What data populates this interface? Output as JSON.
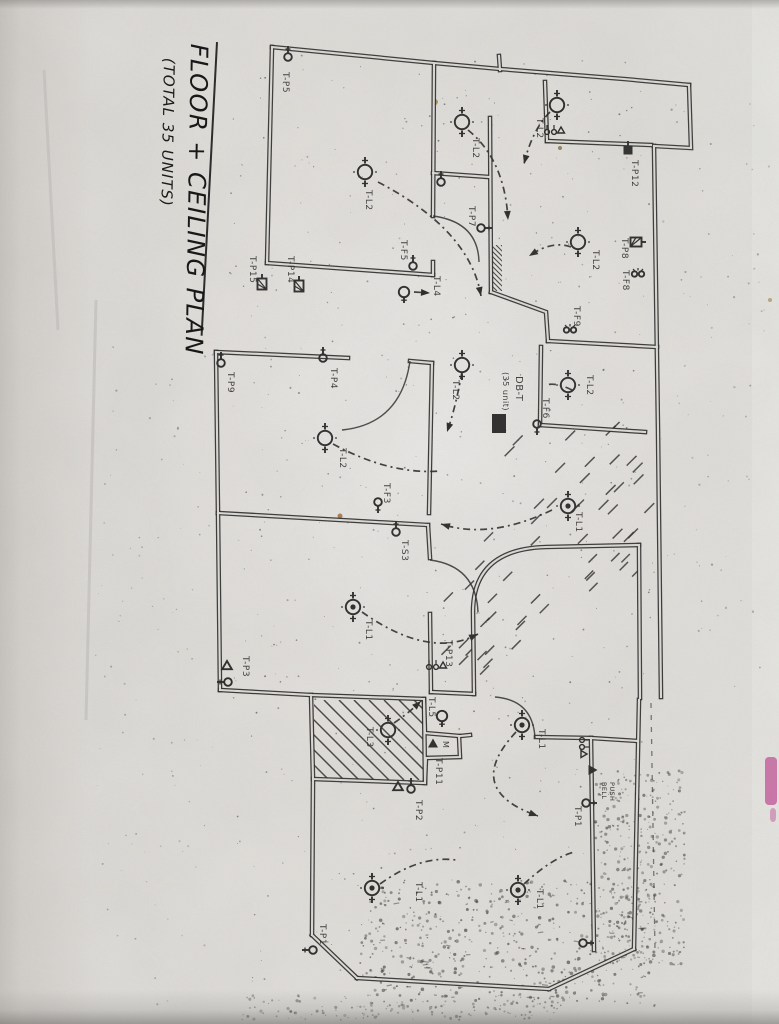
{
  "title": {
    "main": "FLOOR + CEILING PLAN",
    "sub": "(TOTAL 35 UNITS)"
  },
  "distribution_board": {
    "name": "DB-T",
    "capacity": "(35 unit)"
  },
  "annotations": {
    "bell_push": "BELL PUSH",
    "motor": "M"
  },
  "colors": {
    "ink": "#1b1b1b",
    "paper": "#e9e7e3",
    "smudge_pink": "#cc4f9d",
    "crease": "#c7c5c1"
  },
  "fixtures": [
    {
      "t": "light",
      "x": 365,
      "y": 172,
      "label": "T-L2",
      "lx": 366,
      "ly": 190
    },
    {
      "t": "light",
      "x": 462,
      "y": 122,
      "label": "T-L2",
      "lx": 473,
      "ly": 138
    },
    {
      "t": "light",
      "x": 557,
      "y": 105,
      "label": "T-L2",
      "lx": 537,
      "ly": 118
    },
    {
      "t": "light",
      "x": 578,
      "y": 242,
      "label": "T-L2",
      "lx": 593,
      "ly": 250
    },
    {
      "t": "light",
      "x": 568,
      "y": 385,
      "label": "T-L2",
      "lx": 587,
      "ly": 375
    },
    {
      "t": "light",
      "x": 462,
      "y": 365,
      "label": "T-L2",
      "lx": 453,
      "ly": 380
    },
    {
      "t": "light",
      "x": 325,
      "y": 438,
      "label": "T-L2",
      "lx": 340,
      "ly": 448
    },
    {
      "t": "lamp",
      "x": 404,
      "y": 292,
      "label": "T-L4",
      "lx": 434,
      "ly": 276
    },
    {
      "t": "light2",
      "x": 353,
      "y": 607,
      "label": "T-L1",
      "lx": 366,
      "ly": 620
    },
    {
      "t": "light2",
      "x": 568,
      "y": 506,
      "label": "T-L1",
      "lx": 576,
      "ly": 512
    },
    {
      "t": "light",
      "x": 388,
      "y": 730,
      "label": "T-L3",
      "lx": 367,
      "ly": 727
    },
    {
      "t": "lamp",
      "x": 442,
      "y": 716,
      "label": "T-L5",
      "lx": 429,
      "ly": 697
    },
    {
      "t": "light2",
      "x": 522,
      "y": 725,
      "label": "T-L1",
      "lx": 539,
      "ly": 729
    },
    {
      "t": "light2",
      "x": 372,
      "y": 888,
      "label": "T-L1",
      "lx": 416,
      "ly": 882
    },
    {
      "t": "light2",
      "x": 518,
      "y": 890,
      "label": "T-L1",
      "lx": 537,
      "ly": 889
    },
    {
      "t": "rose",
      "x": 288,
      "y": 57,
      "rot": 0,
      "label": "T-P5",
      "lx": 283,
      "ly": 72
    },
    {
      "t": "rose",
      "x": 413,
      "y": 266,
      "rot": 0,
      "label": "T-F5",
      "lx": 401,
      "ly": 240
    },
    {
      "t": "rose",
      "x": 441,
      "y": 182,
      "rot": 0,
      "label": ""
    },
    {
      "t": "rose",
      "x": 481,
      "y": 228,
      "rot": 90,
      "label": "T-P7",
      "lx": 469,
      "ly": 206
    },
    {
      "t": "sqf",
      "x": 628,
      "y": 150,
      "rot": 0,
      "label": "T-P12",
      "lx": 632,
      "ly": 160
    },
    {
      "t": "sqh",
      "x": 636,
      "y": 242,
      "rot": 90,
      "label": "T-P8",
      "lx": 622,
      "ly": 238
    },
    {
      "t": "fan",
      "x": 638,
      "y": 274,
      "rot": 0,
      "label": "T-F8",
      "lx": 623,
      "ly": 270
    },
    {
      "t": "fan",
      "x": 570,
      "y": 330,
      "rot": 0,
      "label": "T-F9",
      "lx": 574,
      "ly": 306
    },
    {
      "t": "sqh",
      "x": 262,
      "y": 284,
      "rot": 0,
      "label": "T-P15",
      "lx": 250,
      "ly": 256
    },
    {
      "t": "sqh",
      "x": 299,
      "y": 286,
      "rot": 0,
      "label": "T-P14",
      "lx": 288,
      "ly": 256
    },
    {
      "t": "rose",
      "x": 323,
      "y": 358,
      "rot": 0,
      "label": "T-P4",
      "lx": 331,
      "ly": 368
    },
    {
      "t": "rose",
      "x": 221,
      "y": 363,
      "rot": 0,
      "label": "T-P9",
      "lx": 228,
      "ly": 372
    },
    {
      "t": "rose",
      "x": 378,
      "y": 502,
      "rot": 180,
      "label": "T-F3",
      "lx": 384,
      "ly": 483
    },
    {
      "t": "rose",
      "x": 396,
      "y": 532,
      "rot": 0,
      "label": "T-S3",
      "lx": 402,
      "ly": 540
    },
    {
      "t": "tri",
      "x": 227,
      "y": 666,
      "rot": 0,
      "label": "T-P3",
      "lx": 243,
      "ly": 656
    },
    {
      "t": "rose",
      "x": 228,
      "y": 682,
      "rot": 270,
      "label": ""
    },
    {
      "t": "cluster",
      "x": 436,
      "y": 666,
      "rot": 0,
      "label": "T-P13",
      "lx": 446,
      "ly": 640
    },
    {
      "t": "trif",
      "x": 433,
      "y": 744,
      "rot": 0,
      "label": "M",
      "lx": 443,
      "ly": 741,
      "fs": 8
    },
    {
      "t": "text",
      "label": "T-P11",
      "lx": 436,
      "ly": 758
    },
    {
      "t": "tri",
      "x": 398,
      "y": 787,
      "rot": 0,
      "label": "T-P2",
      "lx": 416,
      "ly": 800
    },
    {
      "t": "rose",
      "x": 411,
      "y": 789,
      "rot": 0,
      "label": ""
    },
    {
      "t": "trif",
      "x": 592,
      "y": 770,
      "rot": 90,
      "label": ""
    },
    {
      "t": "text2",
      "label": "BELL PUSH",
      "lx": 602,
      "ly": 782,
      "fs": 6.5
    },
    {
      "t": "cluster",
      "x": 583,
      "y": 747,
      "rot": 90,
      "label": ""
    },
    {
      "t": "rose",
      "x": 586,
      "y": 803,
      "rot": 90,
      "label": "T-P1",
      "lx": 575,
      "ly": 806
    },
    {
      "t": "rose",
      "x": 313,
      "y": 950,
      "rot": 270,
      "label": "T-P1",
      "lx": 320,
      "ly": 924
    },
    {
      "t": "rose",
      "x": 583,
      "y": 943,
      "rot": 90,
      "label": ""
    },
    {
      "t": "rose",
      "x": 537,
      "y": 424,
      "rot": 180,
      "label": "T-F6",
      "lx": 543,
      "ly": 398
    },
    {
      "t": "cluster",
      "x": 554,
      "y": 131,
      "rot": 0,
      "label": ""
    },
    {
      "t": "dbrect",
      "x": 492,
      "y": 414,
      "w": 14,
      "h": 19,
      "label": ""
    },
    {
      "t": "text",
      "label": "DB-T",
      "lx": 516,
      "ly": 376,
      "fs": 10
    },
    {
      "t": "text",
      "label": "(35 unit)",
      "lx": 503,
      "ly": 372,
      "fs": 8
    }
  ],
  "plan": {
    "walls": [
      "M272,47 L434,63 L500,69 L624,79 L689,85",
      "M499,56 L500,70",
      "M689,85 L691,148 L654,146",
      "M654,146 L658,430 L661,697",
      "M272,47 L267,263",
      "M267,263 L433,275",
      "M434,63 L433,216",
      "M433,262 L433,275",
      "M433,173 L489,177",
      "M490,118 L491,292",
      "M545,82 L547,141",
      "M547,141 L651,145",
      "M491,292 L546,312 L548,341",
      "M548,341 L657,347",
      "M541,347 L540,425",
      "M540,425 L645,432",
      "M474,694 L473,612 Q473,549 546,547 L639,545",
      "M639,545 L640,698",
      "M216,352 L348,358",
      "M410,361 L432,363",
      "M216,352 L218,513",
      "M432,363 L429,513",
      "M218,513 L428,525",
      "M218,513 L220,690",
      "M428,525 L430,558",
      "M430,614 L431,692",
      "M431,692 L474,694",
      "M220,690 L311,695",
      "M311,695 L424,699 L425,783 L313,779 L311,695",
      "M313,779 L312,935",
      "M312,935 L357,978",
      "M357,978 L549,989",
      "M549,989 L634,949",
      "M634,949 L639,700",
      "M424,699 L425,733 L459,736 L460,757 L426,758",
      "M426,758 L425,783",
      "M460,736 L470,735",
      "M536,737 L591,738",
      "M591,738 L638,741",
      "M591,738 L594,950"
    ],
    "doors": [
      "M433,216 Q478,222 479,262",
      "M410,361 Q401,424 342,430",
      "M430,560 Q476,566 478,612",
      "M535,738 Q533,700 495,697"
    ],
    "arrows": [
      {
        "d": "M378,182 Q470,230 481,296",
        "head": true
      },
      {
        "d": "M468,130 Q505,160 508,220",
        "head": true
      },
      {
        "d": "M550,112 Q532,130 524,164",
        "head": true
      },
      {
        "d": "M571,247 Q552,240 529,256",
        "head": true
      },
      {
        "d": "M333,444 Q390,475 441,471",
        "head": false
      },
      {
        "d": "M362,612 Q430,660 478,634",
        "head": true
      },
      {
        "d": "M552,510 Q490,540 441,524",
        "head": true
      },
      {
        "d": "M394,723 Q410,712 421,701",
        "head": true
      },
      {
        "d": "M516,732 Q462,790 538,816",
        "head": true
      },
      {
        "d": "M380,884 Q420,855 456,860",
        "head": false
      },
      {
        "d": "M524,884 Q552,858 574,852",
        "head": false
      },
      {
        "d": "M462,372 Q455,410 447,432",
        "head": true
      },
      {
        "d": "M572,390 Q556,382 546,385",
        "head": false
      },
      {
        "d": "M414,292 L430,293",
        "head": true
      }
    ],
    "dash_lines": [
      "M651,703 L655,950"
    ],
    "creases": [
      "M96,300 L86,720",
      "M44,70 L58,330"
    ],
    "hatch_zones": [
      {
        "type": "clip",
        "x": 314,
        "y": 700,
        "w": 110,
        "h": 80,
        "step": 15,
        "sw": 1.5
      },
      {
        "type": "clip",
        "x": 492,
        "y": 245,
        "w": 10,
        "h": 46,
        "step": 5,
        "sw": 1.1
      }
    ],
    "dash_hatch": [
      {
        "x": 495,
        "y": 428,
        "w": 150,
        "h": 125,
        "n": 26,
        "len": 14
      },
      {
        "x": 432,
        "y": 540,
        "w": 110,
        "h": 150,
        "n": 22,
        "len": 13
      },
      {
        "x": 580,
        "y": 550,
        "w": 58,
        "h": 48,
        "n": 8,
        "len": 12
      }
    ],
    "speckle_zones": [
      {
        "x": 225,
        "y": 55,
        "w": 430,
        "h": 935,
        "n": 520,
        "rmin": 0.4,
        "rmax": 1.0,
        "o": 0.55
      },
      {
        "x": 360,
        "y": 880,
        "w": 300,
        "h": 128,
        "n": 480,
        "rmin": 0.5,
        "rmax": 1.8,
        "o": 0.6
      },
      {
        "x": 595,
        "y": 770,
        "w": 90,
        "h": 195,
        "n": 320,
        "rmin": 0.5,
        "rmax": 1.7,
        "o": 0.55
      },
      {
        "x": 660,
        "y": 90,
        "w": 110,
        "h": 610,
        "n": 70,
        "rmin": 0.4,
        "rmax": 1.2,
        "o": 0.4
      },
      {
        "x": 95,
        "y": 340,
        "w": 120,
        "h": 670,
        "n": 90,
        "rmin": 0.4,
        "rmax": 1.1,
        "o": 0.35
      },
      {
        "x": 240,
        "y": 995,
        "w": 320,
        "h": 25,
        "n": 150,
        "rmin": 0.5,
        "rmax": 1.6,
        "o": 0.5
      }
    ],
    "flecks": [
      {
        "x": 435,
        "y": 102,
        "c": "#9a7f2f",
        "r": 3
      },
      {
        "x": 340,
        "y": 516,
        "c": "#a15c22",
        "r": 2.5
      },
      {
        "x": 560,
        "y": 148,
        "c": "#7a6a30",
        "r": 2
      },
      {
        "x": 770,
        "y": 300,
        "c": "#b49a62",
        "r": 2
      }
    ],
    "smudges": [
      {
        "x": 765,
        "y": 757,
        "w": 12,
        "h": 48,
        "o": 0.8
      },
      {
        "x": 770,
        "y": 808,
        "w": 6,
        "h": 14,
        "o": 0.5
      }
    ]
  }
}
